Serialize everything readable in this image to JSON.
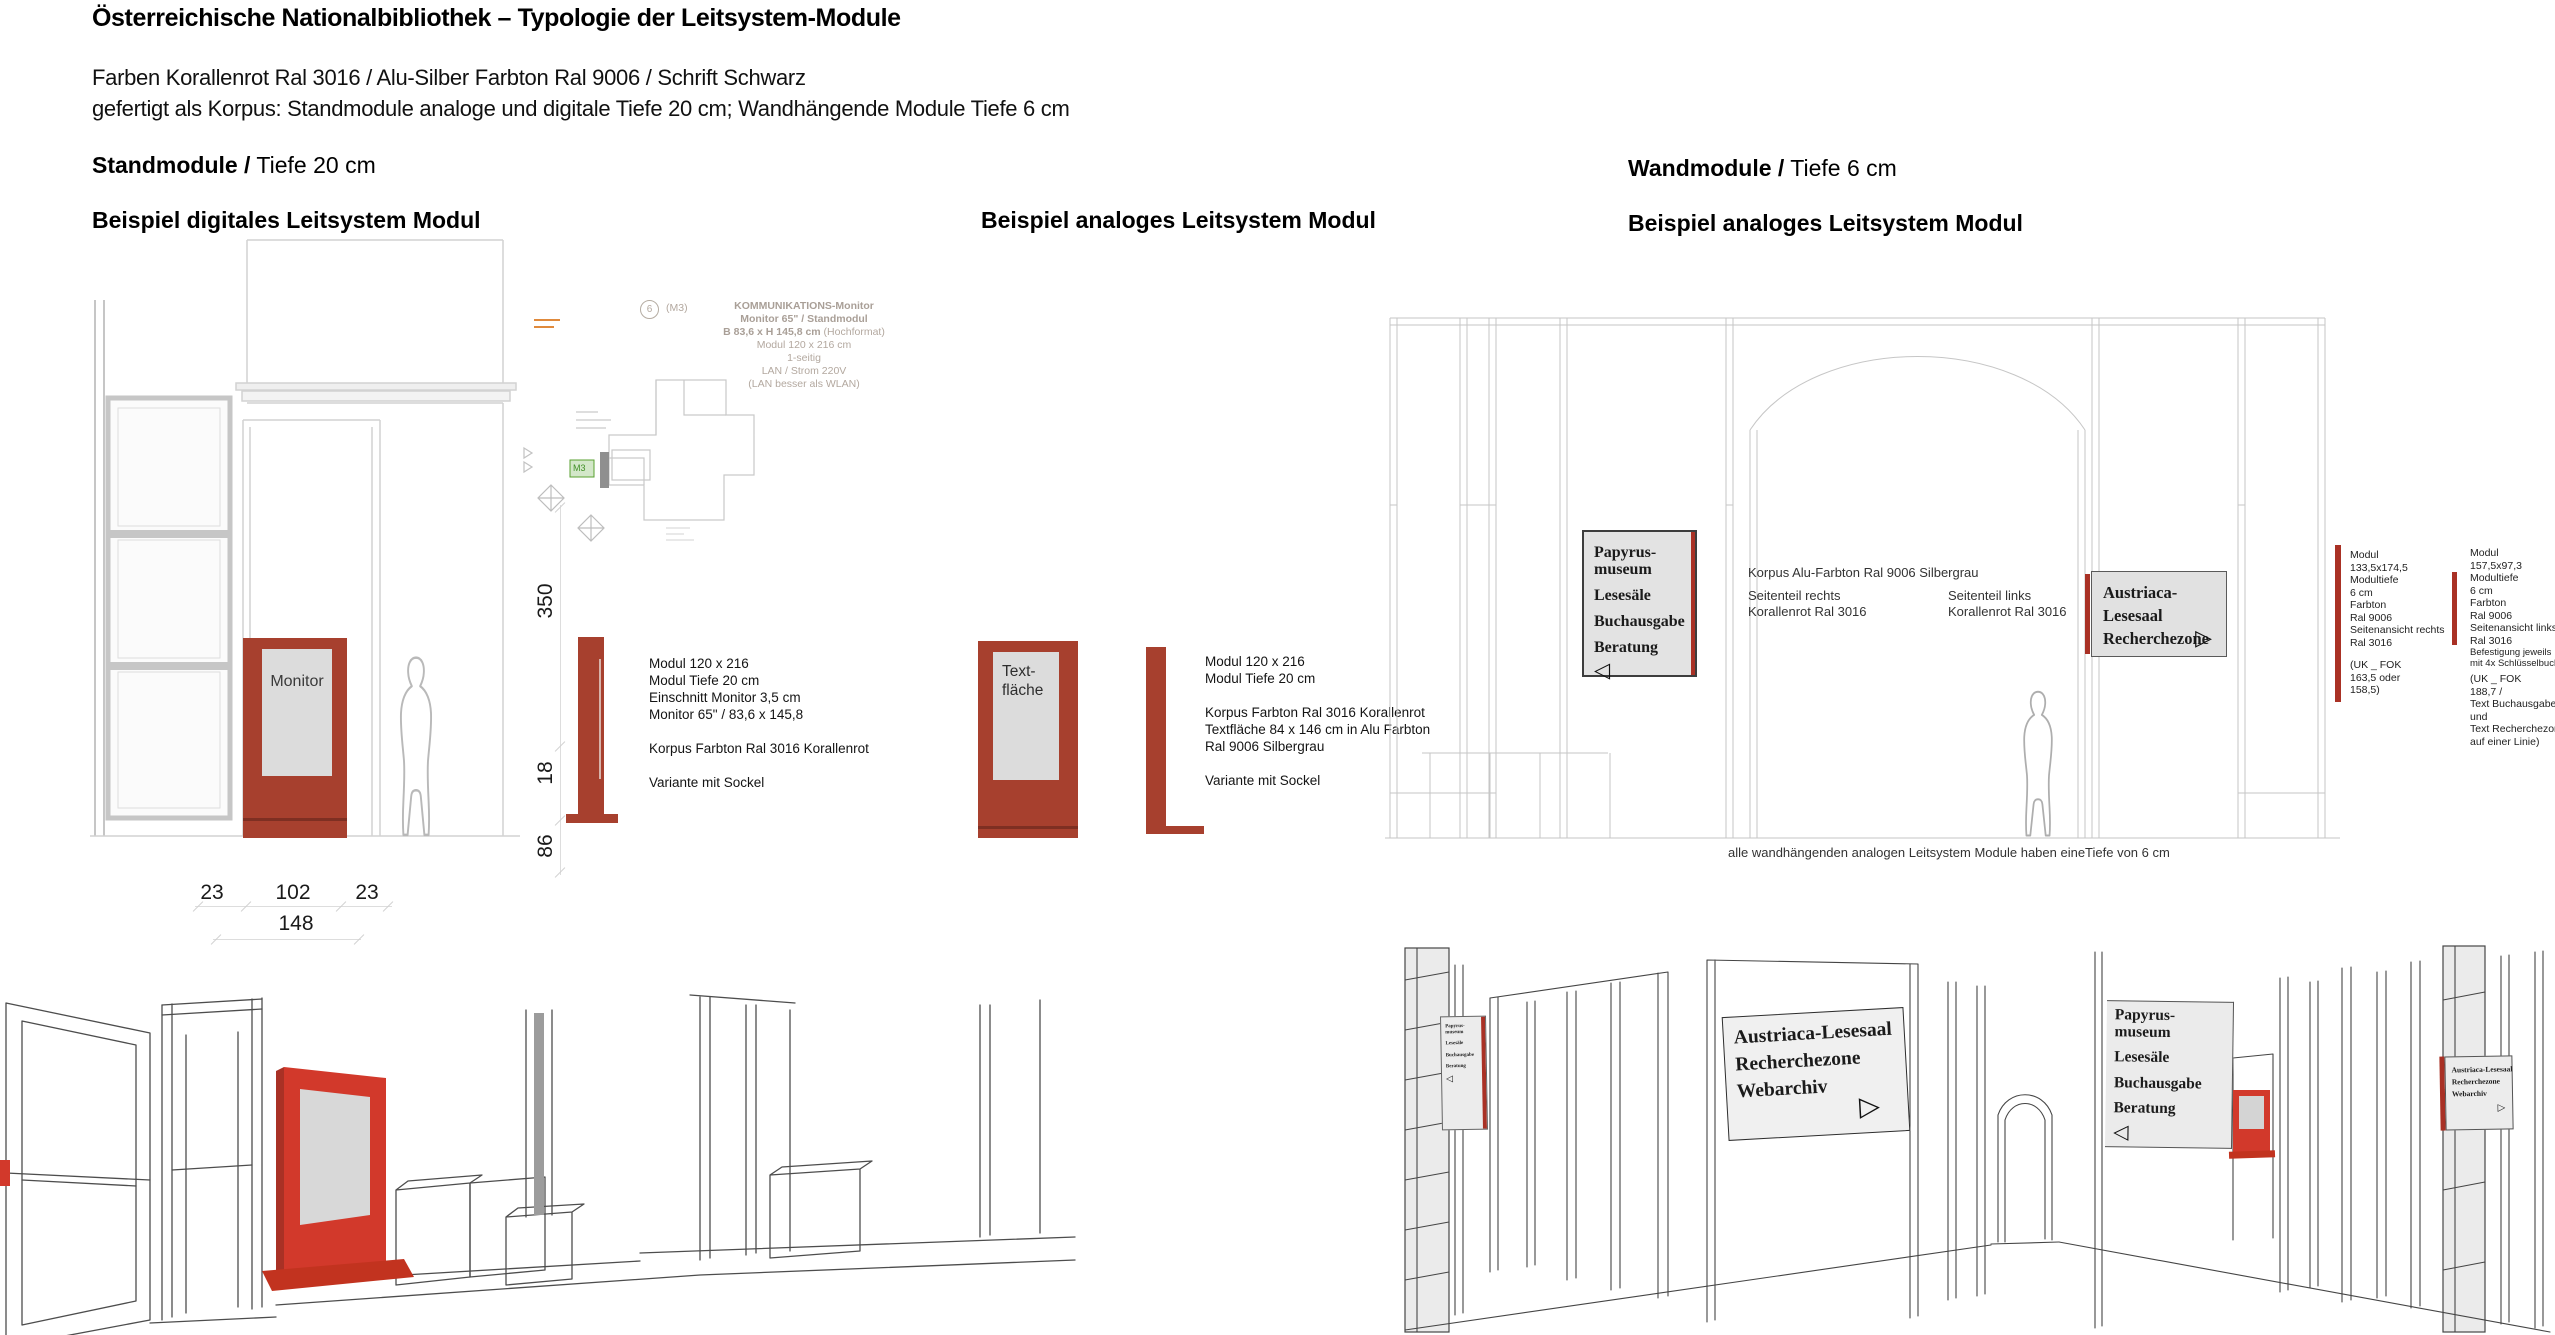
{
  "header": {
    "title": "Österreichische Nationalbibliothek – Typologie der Leitsystem-Module",
    "line1": "Farben Korallenrot Ral 3016 / Alu-Silber Farbton Ral 9006 / Schrift Schwarz",
    "line2": "gefertigt als Korpus: Standmodule analoge und digitale Tiefe 20 cm; Wandhängende Module Tiefe 6 cm"
  },
  "headings": {
    "stand_bold": "Standmodule /",
    "stand_rest": " Tiefe 20 cm",
    "wand_bold": "Wandmodule /",
    "wand_rest": " Tiefe 6 cm",
    "example_digital": "Beispiel digitales Leitsystem Modul",
    "example_analog_stand": "Beispiel analoges Leitsystem Modul",
    "example_analog_wand": "Beispiel analoges Leitsystem Modul"
  },
  "colors": {
    "korallenrot": "#a7402e",
    "korallenrot_bright": "#d2392b",
    "sign_stripe_red": "#a93125",
    "silbergrau": "#dcdcdc"
  },
  "digital_module": {
    "screen_label": "Monitor",
    "plan_ref_number": "6",
    "plan_ref_code": "(M3)",
    "plan_green_label": "M3",
    "plan_note": {
      "l1": "KOMMUNIKATIONS-Monitor",
      "l2": "Monitor 65\" / Standmodul",
      "l3b": "B 83,6 x H 145,8 cm",
      "l3r": " (Hochformat)",
      "l4": "Modul 120 x 216 cm",
      "l5": "1-seitig",
      "l6": "LAN / Strom 220V",
      "l7": "(LAN besser als WLAN)"
    },
    "spec1": [
      "Modul 120 x 216",
      "Modul Tiefe 20 cm",
      "Einschnitt Monitor 3,5 cm",
      "Monitor 65\" / 83,6 x 145,8"
    ],
    "spec2": [
      "Korpus Farbton Ral 3016 Korallenrot"
    ],
    "spec3": [
      "Variante mit Sockel"
    ],
    "dim_height": "350",
    "dim_base_height": "18",
    "dim_sockel": "86",
    "dim_left": "23",
    "dim_center": "102",
    "dim_right": "23",
    "dim_total": "148"
  },
  "analog_module": {
    "screen_line1": "Text-",
    "screen_line2": "fläche",
    "spec1": [
      "Modul 120 x 216",
      "Modul Tiefe 20 cm"
    ],
    "spec2": [
      "Korpus Farbton Ral 3016 Korallenrot",
      "Textfläche 84 x 146 cm in Alu Farbton",
      "Ral 9006 Silbergrau"
    ],
    "spec3": [
      "Variante mit Sockel"
    ]
  },
  "wall_modules": {
    "directory_sign": {
      "l1": "Papyrus-",
      "l2": "museum",
      "l3": "Lesesäle",
      "l4": "Buchausgabe",
      "l5": "Beratung",
      "arrow": "◁"
    },
    "austriaca_sign": {
      "l1": "Austriaca-Lesesaal",
      "l2": "Recherchezone",
      "arrow": "▷"
    },
    "note_korpus": "Korpus Alu-Farbton Ral 9006 Silbergrau",
    "note_right_1": "Seitenteil rechts",
    "note_right_2": "Korallenrot Ral 3016",
    "note_left_1": "Seitenteil links",
    "note_left_2": "Korallenrot Ral 3016",
    "spec_right": [
      "Modul",
      "133,5x174,5",
      "Modultiefe",
      "6 cm",
      "Farbton",
      "Ral 9006",
      "Seitenansicht rechts",
      "Ral 3016"
    ],
    "spec_right_uk": [
      "(UK _ FOK",
      "163,5 oder",
      "158,5)"
    ],
    "spec_left": [
      "Modul",
      "157,5x97,3",
      "Modultiefe",
      "6 cm",
      "Farbton",
      "Ral 9006",
      "Seitenansicht links",
      "Ral 3016"
    ],
    "spec_left_mount": [
      "Befestigung jeweils",
      "mit 4x Schlüsselbuchse"
    ],
    "spec_left_uk": [
      "(UK _ FOK",
      "188,7 /",
      "Text Buchausgabe",
      "und",
      "Text Recherchezone",
      "auf einer Linie)"
    ],
    "caption": "alle wandhängenden analogen Leitsystem Module haben eineTiefe von 6 cm"
  },
  "perspective": {
    "small_directory_sign": {
      "l1": "Papyrus-",
      "l2": "museum",
      "l3": "Lesesäle",
      "l4": "Buchausgabe",
      "l5": "Beratung",
      "arrow": "◁"
    },
    "webarchiv_sign_large": {
      "l1": "Austriaca-Lesesaal",
      "l2": "Recherchezone",
      "l3": "Webarchiv",
      "arrow": "▷"
    },
    "directory_sign_large": {
      "l1": "Papyrus-",
      "l2": "museum",
      "l3": "Lesesäle",
      "l4": "Buchausgabe",
      "l5": "Beratung",
      "arrow": "◁"
    },
    "webarchiv_sign_small": {
      "l1": "Austriaca-Lesesaal",
      "l2": "Recherchezone",
      "l3": "Webarchiv",
      "arrow": "▷"
    }
  }
}
